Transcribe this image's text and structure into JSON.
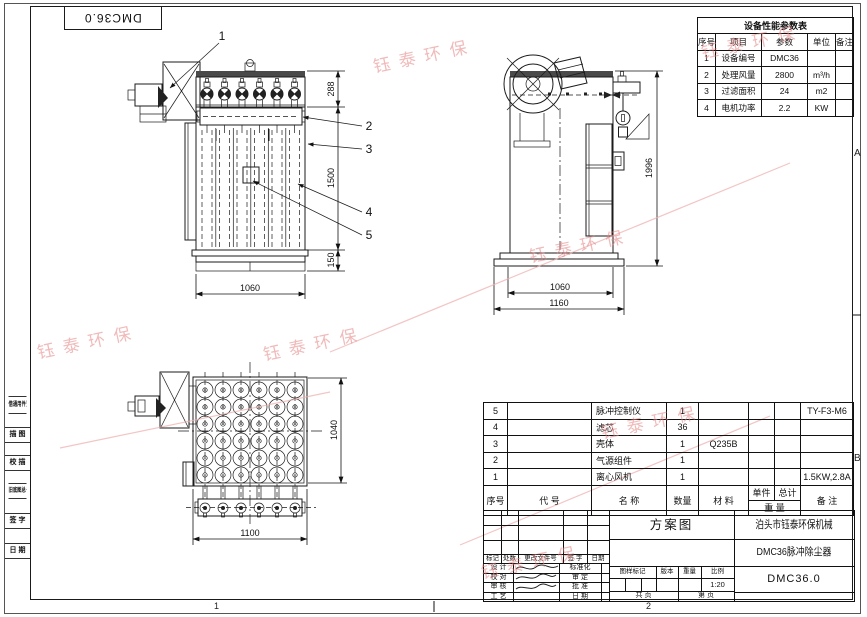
{
  "page": {
    "corner_drawing_no": "DMC36.0",
    "zones": {
      "right_upper": "A",
      "right_lower": "B",
      "bottom_left": "1",
      "bottom_right": "2"
    }
  },
  "left_sidebar": {
    "items": [
      "借通用件登记",
      "描 图",
      "校 描",
      "旧底图总号",
      "签 字",
      "日 期"
    ]
  },
  "watermark": {
    "text": "钰泰环保"
  },
  "perf_table": {
    "title": "设备性能参数表",
    "headers": [
      "序号",
      "项目",
      "参数",
      "单位",
      "备注"
    ],
    "rows": [
      [
        "1",
        "设备编号",
        "DMC36",
        "",
        ""
      ],
      [
        "2",
        "处理风量",
        "2800",
        "m³/h",
        ""
      ],
      [
        "3",
        "过滤面积",
        "24",
        "m2",
        ""
      ],
      [
        "4",
        "电机功率",
        "2.2",
        "KW",
        ""
      ]
    ]
  },
  "bom": {
    "headers": {
      "no": "序号",
      "code": "代  号",
      "name": "名  称",
      "qty": "数量",
      "material": "材  料",
      "weight_unit": "单件",
      "weight_total": "总计",
      "weight": "重  量",
      "remarks": "备  注"
    },
    "rows": [
      {
        "no": "5",
        "code": "",
        "name": "脉冲控制仪",
        "qty": "1",
        "material": "",
        "wu": "",
        "wt": "",
        "remarks": "TY-F3-M6"
      },
      {
        "no": "4",
        "code": "",
        "name": "滤芯",
        "qty": "36",
        "material": "",
        "wu": "",
        "wt": "",
        "remarks": ""
      },
      {
        "no": "3",
        "code": "",
        "name": "壳体",
        "qty": "1",
        "material": "Q235B",
        "wu": "",
        "wt": "",
        "remarks": ""
      },
      {
        "no": "2",
        "code": "",
        "name": "气源组件",
        "qty": "1",
        "material": "",
        "wu": "",
        "wt": "",
        "remarks": ""
      },
      {
        "no": "1",
        "code": "",
        "name": "离心风机",
        "qty": "1",
        "material": "",
        "wu": "",
        "wt": "",
        "remarks": "1.5KW,2.8A"
      }
    ]
  },
  "title_block": {
    "scheme_label": "方案图",
    "company": "泊头市钰泰环保机械",
    "product": "DMC36脉冲除尘器",
    "drawing_no": "DMC36.0",
    "rev_headers": [
      "标记",
      "处数",
      "更改文件号",
      "签 字",
      "日期"
    ],
    "sign_left": [
      "设 计",
      "校 对",
      "审 核",
      "工 艺"
    ],
    "sign_right": [
      "标准化",
      "审 定",
      "批 准",
      "日 期"
    ],
    "mark_headers": [
      "图样标记",
      "版本",
      "重量",
      "比例"
    ],
    "scale_value": "1:20",
    "sheet_total": "共  页",
    "sheet_no": "第  页"
  },
  "views": {
    "front": {
      "dim_288": "288",
      "dim_1500": "1500",
      "dim_150": "150",
      "dim_1060": "1060",
      "callout_1": "1",
      "callout_2": "2",
      "callout_3": "3",
      "callout_4": "4",
      "callout_5": "5"
    },
    "side": {
      "dim_1996": "1996",
      "dim_1060": "1060",
      "dim_1160": "1160"
    },
    "top": {
      "dim_1040": "1040",
      "dim_1100": "1100"
    }
  }
}
